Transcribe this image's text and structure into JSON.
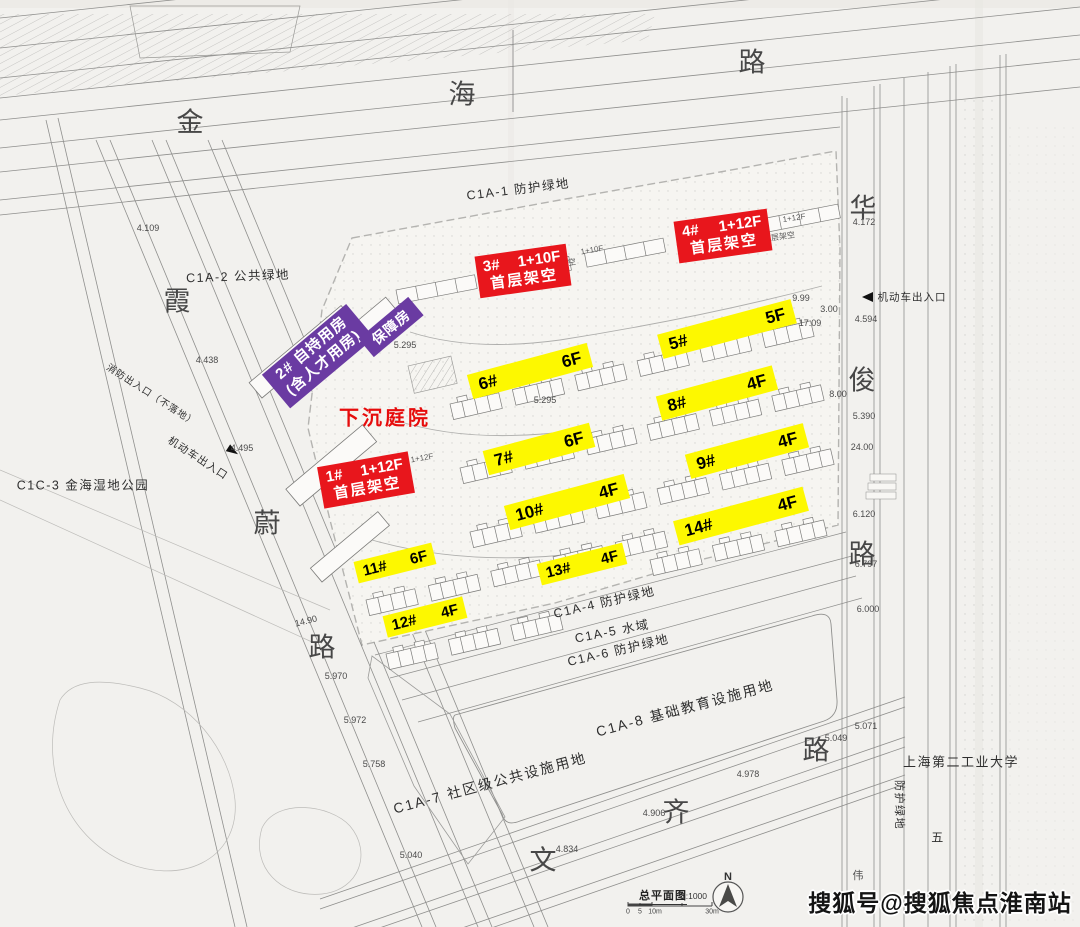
{
  "roads": {
    "top": [
      "金",
      "海",
      "路"
    ],
    "right": [
      "华",
      "俊",
      "路"
    ],
    "left": [
      "霞",
      "蔚",
      "路"
    ],
    "bottom": [
      "文",
      "齐",
      "路"
    ],
    "extra": "伟"
  },
  "zones": {
    "c1a1": "C1A-1 防护绿地",
    "c1a2": "C1A-2 公共绿地",
    "c1c3": "C1C-3 金海湿地公园",
    "c1a4": "C1A-4 防护绿地",
    "c1a5": "C1A-5 水域",
    "c1a6": "C1A-6 防护绿地",
    "c1a8": "C1A-8 基础教育设施用地",
    "c1a7": "C1A-7 社区级公共设施用地",
    "university": "上海第二工业大学",
    "green_v": "防护绿地",
    "wu": "五"
  },
  "entrances": {
    "right_motor": "机动车出入口",
    "left_motor": "机动车出入口",
    "left_fire": "消防出入口（不落地）"
  },
  "red_blocks": {
    "b3": {
      "id": "3#",
      "floors": "1+10F",
      "note": "首层架空"
    },
    "b4": {
      "id": "4#",
      "floors": "1+12F",
      "note": "首层架空"
    },
    "b1": {
      "id": "1#",
      "floors": "1+12F",
      "note": "首层架空"
    }
  },
  "purple": {
    "line1": "2# 自持用房",
    "line2": "(含人才用房)",
    "tag": "保障房"
  },
  "courtyard": "下沉庭院",
  "yellow": {
    "b5": {
      "id": "5#",
      "floors": "5F"
    },
    "b6": {
      "id": "6#",
      "floors": "6F"
    },
    "b7": {
      "id": "7#",
      "floors": "6F"
    },
    "b8": {
      "id": "8#",
      "floors": "4F"
    },
    "b9": {
      "id": "9#",
      "floors": "4F"
    },
    "b10": {
      "id": "10#",
      "floors": "4F"
    },
    "b11": {
      "id": "11#",
      "floors": "6F"
    },
    "b12": {
      "id": "12#",
      "floors": "4F"
    },
    "b13": {
      "id": "13#",
      "floors": "4F"
    },
    "b14": {
      "id": "14#",
      "floors": "4F"
    }
  },
  "levels": [
    "4.109",
    "4.438",
    "4.495",
    "4.172",
    "4.594",
    "5.390",
    "24.00",
    "6.120",
    "6.797",
    "6.000",
    "5.071",
    "5.049",
    "4.978",
    "4.906",
    "4.834",
    "5.040",
    "5.758",
    "5.972",
    "5.970",
    "14.90",
    "9.99",
    "17.09",
    "3.00",
    "8.00",
    "5.295",
    "5.295"
  ],
  "tiny": [
    "1+10F",
    "架空",
    "首层架空",
    "1+12F",
    "1+12F"
  ],
  "legend": {
    "title": "总平面图",
    "scale": "1:1000",
    "north": "N",
    "t0": "0",
    "t1": "5",
    "t2": "10m",
    "t3": "30m"
  },
  "watermark": "搜狐号@搜狐焦点淮南站"
}
